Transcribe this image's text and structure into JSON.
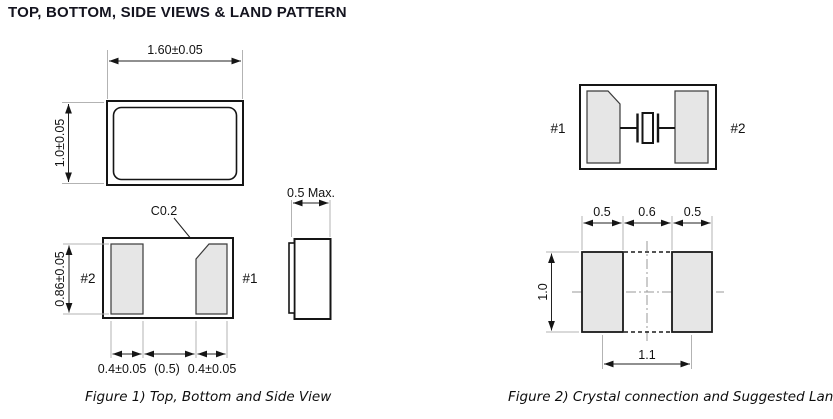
{
  "title": "TOP, BOTTOM, SIDE VIEWS & LAND PATTERN",
  "figure1": {
    "caption": "Figure 1) Top, Bottom and Side View",
    "top_view": {
      "width_dim": "1.60±0.05",
      "height_dim": "1.0±0.05"
    },
    "bottom_view": {
      "chamfer_label": "C0.2",
      "pad_left_label": "#2",
      "pad_right_label": "#1",
      "pad_height_dim": "0.86±0.05",
      "pad_width_left_dim": "0.4±0.05",
      "gap_dim": "(0.5)",
      "pad_width_right_dim": "0.4±0.05"
    },
    "side_view": {
      "thickness_dim": "0.5 Max."
    }
  },
  "figure2": {
    "caption": "Figure 2) Crystal connection and Suggested  Land",
    "crystal_connection": {
      "pad_left_label": "#1",
      "pad_right_label": "#2"
    },
    "land_pattern": {
      "pad_left_width_dim": "0.5",
      "gap_dim": "0.6",
      "pad_right_width_dim": "0.5",
      "pad_height_dim": "1.0",
      "center_spacing_dim": "1.1"
    }
  },
  "colors": {
    "line": "#151515",
    "pad_fill": "#e6e6e6",
    "extension_line": "#b3b3b3",
    "title": "#14141f"
  }
}
